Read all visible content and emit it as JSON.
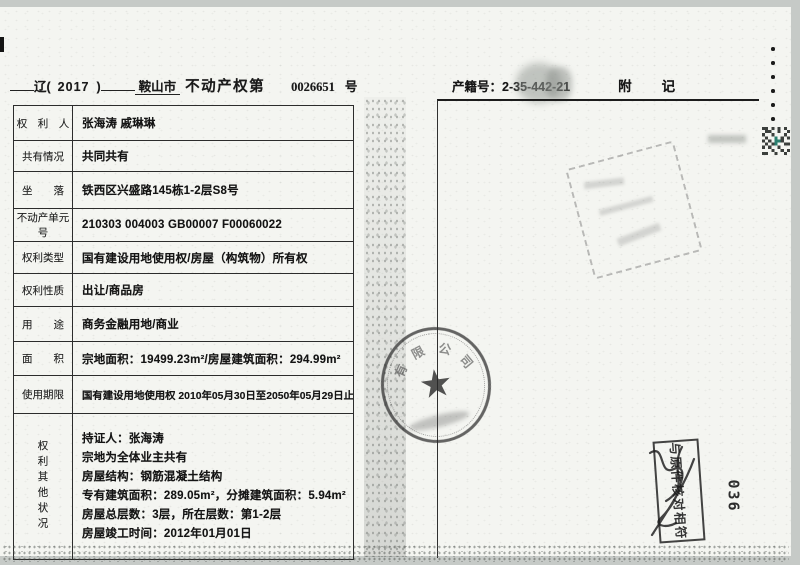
{
  "colors": {
    "page_bg": "#f4f5f1",
    "scanner_bg": "#c6cac7",
    "ink": "#1a1a1a",
    "table_border": "#2c2c2c",
    "qr_green": "#2a7f6f"
  },
  "header": {
    "left": {
      "province": "辽(",
      "year": "2017",
      "close": ")",
      "city": "鞍山市",
      "doc_type": "不动产权第",
      "serial": "0026651",
      "suffix": "号"
    },
    "right": {
      "registry_label": "产籍号：",
      "registry_number": "2-35-442-21",
      "annex_char_1": "附",
      "annex_char_2": "记"
    }
  },
  "table": {
    "rows": [
      {
        "label": "权　利　人",
        "value": "张海涛 戚琳琳"
      },
      {
        "label": "共有情况",
        "value": "共同共有"
      },
      {
        "label": "坐　　落",
        "value": "铁西区兴盛路145栋1-2层S8号"
      },
      {
        "label": "不动产单元号",
        "value": "210303 004003 GB00007 F00060022"
      },
      {
        "label": "权利类型",
        "value": "国有建设用地使用权/房屋（构筑物）所有权"
      },
      {
        "label": "权利性质",
        "value": "出让/商品房"
      },
      {
        "label": "用　　途",
        "value": "商务金融用地/商业"
      },
      {
        "label": "面　　积",
        "value": "宗地面积：19499.23m²/房屋建筑面积：294.99m²"
      },
      {
        "label": "使用期限",
        "value": "国有建设用地使用权 2010年05月30日至2050年05月29日止"
      }
    ],
    "other_rights": {
      "label": "权利其他状况",
      "lines": [
        "持证人：张海涛",
        "宗地为全体业主共有",
        "房屋结构：钢筋混凝土结构",
        "专有建筑面积：289.05m²，分摊建筑面积：5.94m²",
        "房屋总层数：3层，所在层数：第1-2层",
        "房屋竣工时间：2012年01月01日"
      ]
    }
  },
  "stamps": {
    "round_seal": {
      "arc_chars": [
        "有",
        "限",
        "公",
        "司"
      ],
      "star": "★"
    },
    "verify_stamp": {
      "text": "与原件核对相符"
    },
    "page_code": "036"
  }
}
